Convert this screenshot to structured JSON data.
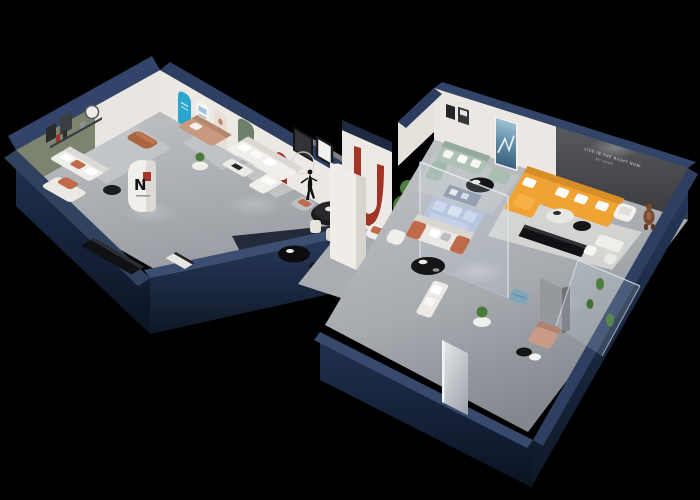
{
  "scene": {
    "type": "3d-isometric-showroom-floorplan-render",
    "background": "#000000",
    "feature_wall": {
      "slogan_line1": "LIVE IN THE RIGHT NOW",
      "slogan_line2": "MY HOME"
    },
    "brand_column": {
      "logo_letter": "N"
    },
    "key_objects": [
      "navy cutaway outer walls",
      "gray showroom floors",
      "olive accent wall with framed art",
      "cyan arch poster",
      "white arch poster",
      "portrait arch poster",
      "green door",
      "red arch niche",
      "copper leather ottoman",
      "white sectional sofa",
      "tan sofa",
      "black dining table with cream chairs",
      "dancer sculpture",
      "red U arch graphic column",
      "N brand column",
      "black media console",
      "ficus tree",
      "orange sectional sofa",
      "charcoal feature wall with slogan",
      "sage green sofa",
      "blue abstract painting",
      "glass inner room with periwinkle sofa display",
      "white sofa with rust cushions",
      "black oval coffee tables",
      "teddy bear sculpture",
      "glass cactus display case",
      "blue ottoman",
      "tan lounge chair",
      "doorway mirror panel",
      "floor spotlights"
    ],
    "colors": {
      "outer_wall_cap": "#3a4c70",
      "outer_wall_face": "#1c2a44",
      "outer_wall_dark": "#121b2d",
      "floor": "#b3b6ba",
      "floor_dark": "#8e9298",
      "interior_wall": "#eae7e2",
      "olive_wall": "#7c8470",
      "charcoal_wall": "#47484c",
      "orange_sofa": "#f0a233",
      "rust_accent": "#c06a4a",
      "sage_sofa": "#adc2b5",
      "periwinkle": "#b5c2de",
      "cyan_poster": "#2ba6cd",
      "red_accent": "#a23326",
      "copper_ottoman": "#aa6540",
      "tan_sofa": "#c99a7f",
      "plant_green": "#4a7a3b",
      "white_furniture": "#f0eeea",
      "black_furniture": "#17181a",
      "glass": "#cfe2ea",
      "teddy_brown": "#7a4a33",
      "blue_ottoman": "#7fa6ba",
      "lounge_tan": "#c89a87"
    }
  }
}
